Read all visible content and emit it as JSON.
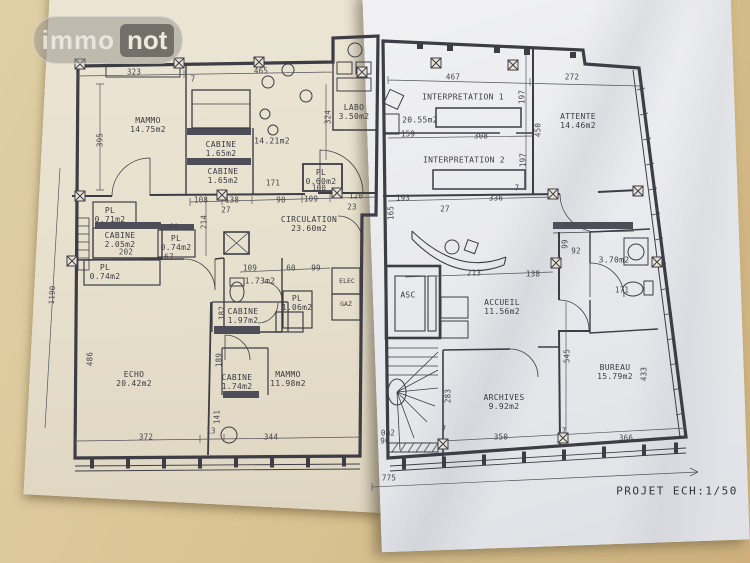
{
  "watermark": {
    "brand_left": "immo",
    "brand_right": "not"
  },
  "footer": {
    "scale_label": "PROJET ECH:1/50"
  },
  "left_plan": {
    "rooms": [
      {
        "name": "MAMMO",
        "area": "14.75m2"
      },
      {
        "name": "CABINE",
        "area": "1.65m2"
      },
      {
        "name": "",
        "area": "14.21m2"
      },
      {
        "name": "CABINE",
        "area": "1.65m2"
      },
      {
        "name": "LABO",
        "area": "3.50m2"
      },
      {
        "name": "PL",
        "area": "0.60m2"
      },
      {
        "name": "PL",
        "area": "0.71m2"
      },
      {
        "name": "CABINE",
        "area": "2.05m2"
      },
      {
        "name": "PL",
        "area": "0.74m2"
      },
      {
        "name": "PL",
        "area": "0.74m2"
      },
      {
        "name": "CIRCULATION",
        "area": "23.60m2"
      },
      {
        "name": "",
        "area": "1.73m2"
      },
      {
        "name": "PL",
        "area": "1.06m2"
      },
      {
        "name": "CABINE",
        "area": "1.97m2"
      },
      {
        "name": "ECHO",
        "area": "20.42m2"
      },
      {
        "name": "CABINE",
        "area": "1.74m2"
      },
      {
        "name": "MAMMO",
        "area": "11.98m2"
      }
    ],
    "utilities": [
      "ELEC",
      "GAZ"
    ],
    "dims_h": [
      "323",
      "465",
      "7",
      "171",
      "100",
      "108",
      "27",
      "138",
      "90",
      "109",
      "120",
      "23",
      "202",
      "60",
      "67",
      "109",
      "60",
      "99",
      "372",
      "13",
      "344"
    ],
    "dims_v": [
      "1190",
      "395",
      "324",
      "214",
      "182",
      "189",
      "141",
      "486"
    ]
  },
  "right_plan": {
    "rooms": [
      {
        "name": "INTERPRETATION 1",
        "area": "20.55m2"
      },
      {
        "name": "INTERPRETATION 2",
        "area": ""
      },
      {
        "name": "ATTENTE",
        "area": "14.46m2"
      },
      {
        "name": "ASC",
        "area": ""
      },
      {
        "name": "ACCUEIL",
        "area": "11.56m2"
      },
      {
        "name": "",
        "area": "3.70m2"
      },
      {
        "name": "ARCHIVES",
        "area": "9.92m2"
      },
      {
        "name": "BUREAU",
        "area": "15.79m2"
      }
    ],
    "dims_h": [
      "467",
      "272",
      "159",
      "308",
      "193",
      "336",
      "27",
      "7",
      "213",
      "138",
      "92",
      "171",
      "7",
      "350",
      "7",
      "366",
      "775",
      "90"
    ],
    "dims_v": [
      "197",
      "450",
      "197",
      "165",
      "99",
      "545",
      "433",
      "283"
    ],
    "partial_label": "0m2"
  }
}
